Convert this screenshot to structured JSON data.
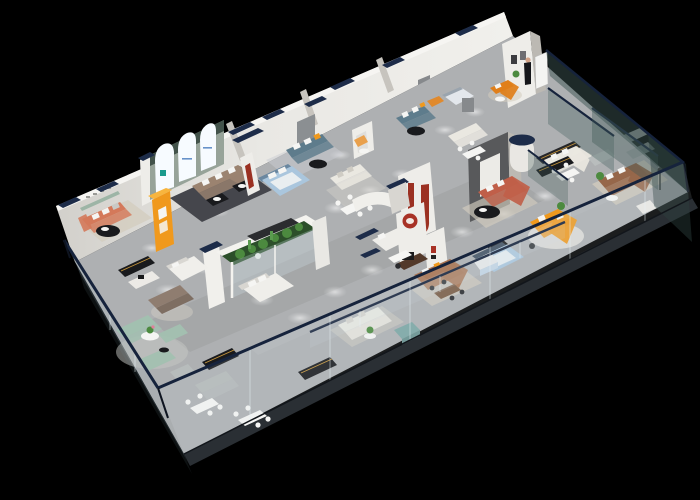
{
  "scene": {
    "title": "Isometric 3D cutaway render of a furniture showroom floor plan on a black background",
    "canvas": {
      "width": 700,
      "height": 500
    },
    "background": "#000000"
  },
  "colors": {
    "background": "#000000",
    "floor": "#aeb0b2",
    "slab": "#2a2f34",
    "slab_dark": "#1b1f23",
    "wall_lit": "#eeede9",
    "wall_mid": "#d8d6d1",
    "wall_shade": "#bcb9b3",
    "cap_navy": "#1d2c49",
    "rail_navy": "#16233c",
    "glass_tint": "#cfe3ea",
    "glass_dark": "#3c5452",
    "green_wall_band": "#42524a",
    "green_wall_face": "#97a399",
    "arch_glow": "#f7fbff",
    "logo_teal": "#1a9a8c",
    "logo_blue": "#4d7fc0",
    "accent_orange": "#f0991d",
    "orange_deep": "#e07f1a",
    "sofa_coral": "#c05f49",
    "sofa_salmon": "#d4795a",
    "sofa_taupe": "#9b8370",
    "sofa_brown": "#96674a",
    "sofa_caramel": "#a87250",
    "walnut": "#53392a",
    "sofa_teal": "#5e7c8c",
    "sofa_sage": "#a2c0b0",
    "sofa_cream": "#eae8e1",
    "bed_blue": "#aac6dd",
    "rug_dark": "#45464c",
    "rug_beige": "#d3ccbe",
    "rug_gray": "#c6c5c1",
    "furniture_black": "#191a1d",
    "gold_strip": "#c8973c",
    "charcoal_wall": "#58595b",
    "red_wall": "#9b3122",
    "red_logo": "#a83226",
    "plant_green": "#4c8a3f",
    "plant_dark": "#2c4f2a",
    "skin": "#d2a287",
    "white": "#f5f5f3",
    "gray_sofa": "#b5b9b8",
    "steel_panel": "#8d9194",
    "navy_panel": "#26384f"
  },
  "objects": [
    {
      "name": "glass-curtain-wall-sw",
      "desc": "tall exterior glass wall with navy top rail, left edge"
    },
    {
      "name": "glass-curtain-wall-se",
      "desc": "long exterior glass wall with navy top rail, bottom edge"
    },
    {
      "name": "glass-wall-ne",
      "desc": "dark exterior glass end wall, right edge"
    },
    {
      "name": "glass-partitions-right",
      "desc": "interior glass partition panels dividing right-side rooms"
    },
    {
      "name": "glass-balustrade",
      "desc": "interior glass balustrade crossing the showroom"
    },
    {
      "name": "back-wall",
      "desc": "white perimeter wall with navy capped pilasters, top-left edge"
    },
    {
      "name": "arched-green-wall",
      "desc": "sage green wall with three glowing white arched niches and brand marks"
    },
    {
      "name": "orange-wardrobe",
      "desc": "bright amber display cabinet"
    },
    {
      "name": "sofa-lounge-left",
      "desc": "salmon three-seat sofa with black oval coffee table"
    },
    {
      "name": "living-set-taupe",
      "desc": "taupe L-shaped sectional on dark rug with black coffee tables"
    },
    {
      "name": "bedroom-blue",
      "desc": "light blue bed display with teal sofa and window panel"
    },
    {
      "name": "red-j-wall",
      "desc": "white partition with maroon J-shaped ribbon niche"
    },
    {
      "name": "red-circle-logo",
      "desc": "round red logo plate on white wall"
    },
    {
      "name": "feature-wall-charcoal",
      "desc": "charcoal feature wall with white panel and navy-topped cylinder column"
    },
    {
      "name": "sofa-coral-sectional",
      "desc": "terracotta sectional with black oval table"
    },
    {
      "name": "sofa-orange-l",
      "desc": "bright orange L-shaped sofa on round cream rug"
    },
    {
      "name": "sofa-brown-leather",
      "desc": "brown leather sofa with white armchair and floor lamp"
    },
    {
      "name": "aquarium-planter",
      "desc": "large white-framed glass terrarium with cacti and plants"
    },
    {
      "name": "bed-white-small",
      "desc": "white bed displays near terrarium"
    },
    {
      "name": "consoles-black",
      "desc": "black display consoles with brass light strips along the aisle"
    },
    {
      "name": "sofa-sage-group",
      "desc": "sage green modular sofa group with pedestal table"
    },
    {
      "name": "dining-sets-white",
      "desc": "white dining tables with chairs"
    },
    {
      "name": "sofa-caramel-suite",
      "desc": "caramel leather suite with walnut sideboard and dining table"
    },
    {
      "name": "bedroom-lightblue-right",
      "desc": "light blue bed with black media unit"
    },
    {
      "name": "sofa-cream-displays",
      "desc": "cream and white sofa displays"
    },
    {
      "name": "ottoman-teal",
      "desc": "teal storage ottoman"
    },
    {
      "name": "sales-person",
      "desc": "tiny staff figure beside white presentation board"
    },
    {
      "name": "ceiling-spotlights",
      "desc": "soft white spotlight pools on the gray floor"
    }
  ]
}
